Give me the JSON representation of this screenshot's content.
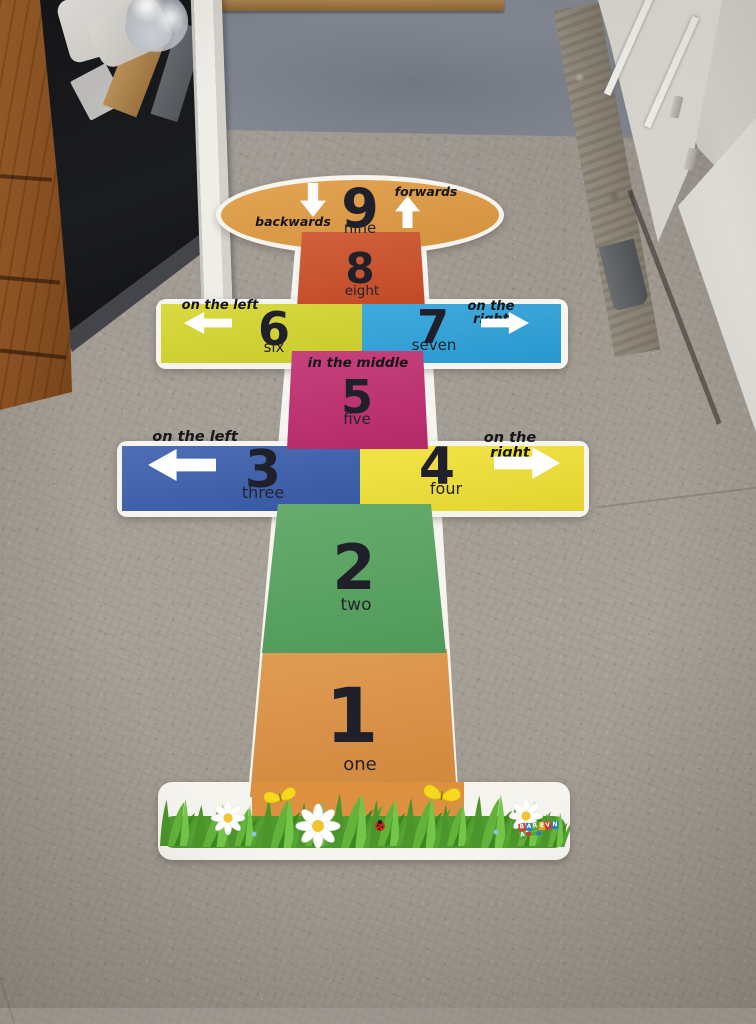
{
  "scene": {
    "floor_color": "#a39d94",
    "doorway_floor_color": "#81868c",
    "door_color": "#e8e5df",
    "wall_color": "#d6d3cd",
    "cabinet_wood_color": "#9c5e28",
    "cabinet_dark_color": "#17181a",
    "threshold_wood_color": "#a8824c"
  },
  "mat": {
    "outline_color": "#f6f4ef",
    "number_color": "#20202a",
    "arrow_color": "#ffffff",
    "tile1": {
      "number": "1",
      "word": "one",
      "color": "#dd9040"
    },
    "tile2": {
      "number": "2",
      "word": "two",
      "color": "#55a35e"
    },
    "tile3": {
      "number": "3",
      "word": "three",
      "color": "#3a5dac",
      "label": "on the left"
    },
    "tile4": {
      "number": "4",
      "word": "four",
      "color": "#f1e134",
      "label": "on the right"
    },
    "tile5": {
      "number": "5",
      "word": "five",
      "color": "#bf2c6e",
      "label": "in the middle"
    },
    "tile6": {
      "number": "6",
      "word": "six",
      "color": "#d5d62c",
      "label": "on the left"
    },
    "tile7": {
      "number": "7",
      "word": "seven",
      "color": "#2ba1da",
      "label": "on the right"
    },
    "tile8": {
      "number": "8",
      "word": "eight",
      "color": "#cc4e27"
    },
    "tile9": {
      "number": "9",
      "word": "nine",
      "color": "#e09a41",
      "label_backwards": "backwards",
      "label_forwards": "forwards"
    }
  },
  "logo": {
    "letters": [
      "B",
      "A",
      "R",
      "E",
      "V",
      "N",
      "A"
    ],
    "tile_colors": [
      "#d23b2f",
      "#2f7fc1",
      "#58a33a",
      "#e8a02b",
      "#d23b2f",
      "#2f7fc1",
      "#58a33a"
    ]
  }
}
